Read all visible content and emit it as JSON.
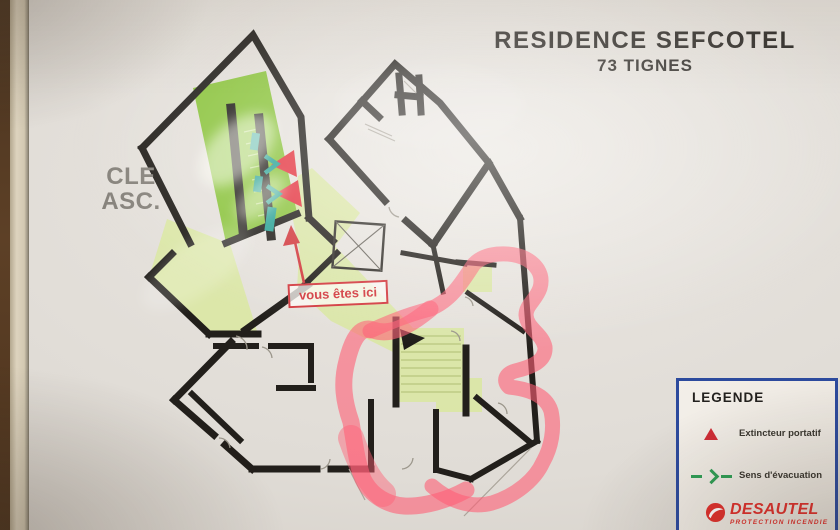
{
  "title": {
    "line1": "RESIDENCE SEFCOTEL",
    "line2": "73 TIGNES"
  },
  "annotations": {
    "key_note_line1": "CLE",
    "key_note_line2": "ASC.",
    "you_are_here": "vous êtes ici"
  },
  "legend": {
    "title": "LEGENDE",
    "items": [
      {
        "icon": "extinguisher-triangle-icon",
        "label": "Extincteur portatif"
      },
      {
        "icon": "evacuation-direction-icon",
        "label": "Sens d'évacuation"
      }
    ],
    "brand": "DESAUTEL",
    "brand_subtitle": "PROTECTION INCENDIE"
  },
  "colors": {
    "wall_black": "#221f1b",
    "corridor_green": "#dbe7a5",
    "stairwell_green": "#8cc43e",
    "route_marker_pink": "#ff5f76",
    "alarm_red": "#d2393e",
    "evacuation_teal": "#2ba396",
    "legend_border_blue": "#2c4a9d",
    "brand_red": "#e0302c"
  }
}
